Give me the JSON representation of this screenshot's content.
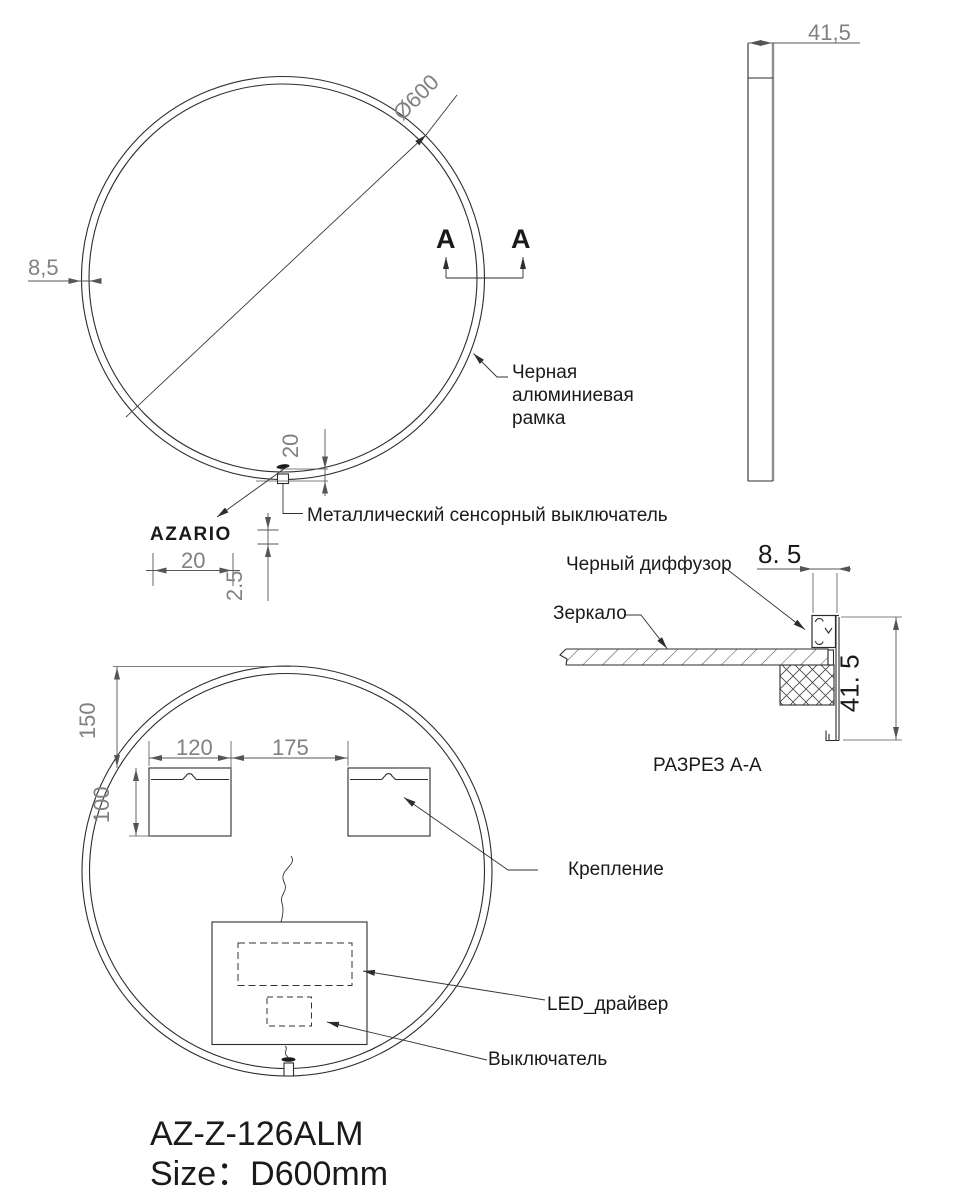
{
  "front_view": {
    "diameter": "Ø600",
    "frame_thickness": "8,5",
    "section_marker": "A",
    "frame_label": "Черная\nалюминиевая\nрамка",
    "touch_switch_label": "Металлический сенсорный выключатель",
    "logo": "AZARIO",
    "switch_offset": "20",
    "logo_width": "20",
    "logo_gap": "2.5"
  },
  "side_view": {
    "depth": "41,5"
  },
  "section_view": {
    "title": "РАЗРЕЗ А-А",
    "diffuser_label": "Черный диффузор",
    "mirror_label": "Зеркало",
    "lip_width": "8. 5",
    "profile_depth": "41. 5"
  },
  "back_view": {
    "top_offset": "150",
    "bracket_width": "120",
    "bracket_spacing": "175",
    "bracket_height": "100",
    "bracket_label": "Крепление",
    "led_driver_label": "LED_драйвер",
    "switch_label": "Выключатель"
  },
  "footer": {
    "model": "AZ-Z-126ALM",
    "size": "Size：D600mm"
  },
  "colors": {
    "line": "#2d2d2d",
    "dim_text": "#818181"
  }
}
